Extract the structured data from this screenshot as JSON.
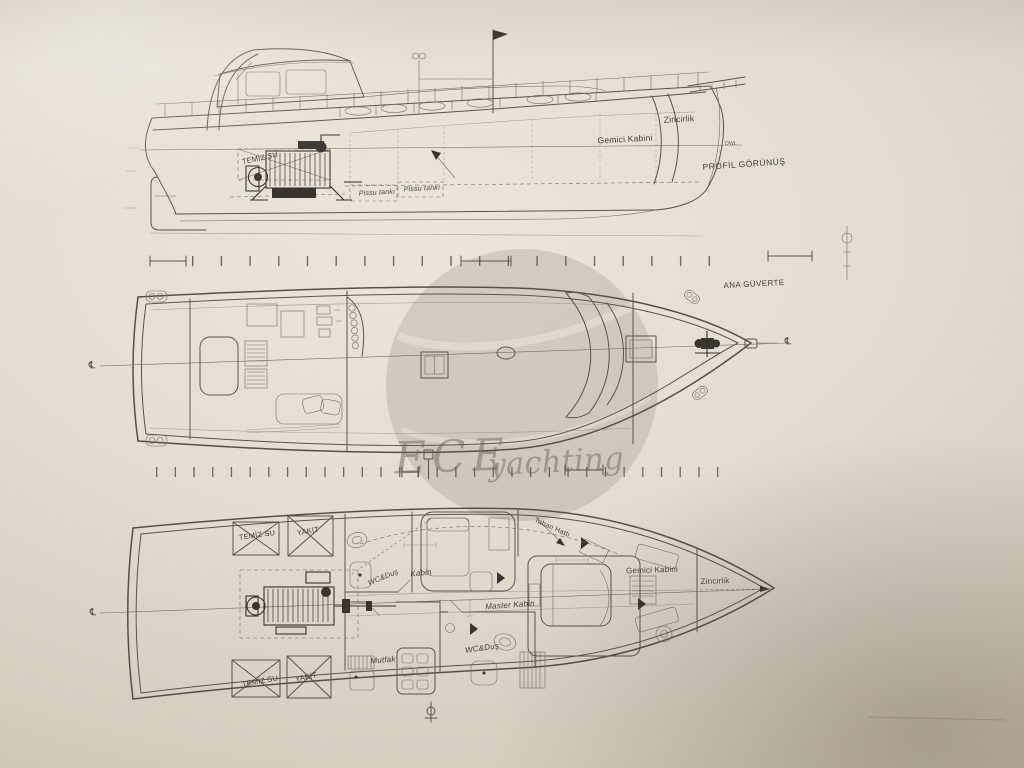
{
  "watermark": {
    "brand": "ECE",
    "word": "yachting"
  },
  "symbols": {
    "centerline": "℄"
  },
  "profile_view": {
    "title": "PROFİL GÖRÜNÜŞ",
    "labels": {
      "zincirlik": "Zincirlik",
      "gemici_kabini": "Gemici Kabini",
      "temiz_su": "TEMİZ SU",
      "pissu_tanki_1": "Pissu tankı",
      "pissu_tanki_2": "Pissu tankı",
      "dwl": "DWL"
    }
  },
  "main_deck_view": {
    "title": "ANA GÜVERTE"
  },
  "lower_deck_view": {
    "labels": {
      "temiz_su_upper": "TEMİZ SU",
      "yakit_upper": "YAKIT",
      "wc_dus_fwd": "WC&Duş",
      "kabin": "Kabin",
      "master_kabin": "Master Kabin",
      "gemici_kabini": "Gemici Kabini",
      "zincirlik": "Zincirlik",
      "taban_hatti": "Taban Hattı",
      "mutfak": "Mutfak",
      "wc_dus_aft": "WC&Duş",
      "temiz_su_lower": "TEMİZ SU",
      "yakit_lower": "YAKIT"
    }
  },
  "colors": {
    "paper": "#e8e1d5",
    "paper_edge": "#bdb4a4",
    "ink": "#5a544b",
    "label_ink": "#46403a",
    "watermark_gray": "#948c7c"
  }
}
